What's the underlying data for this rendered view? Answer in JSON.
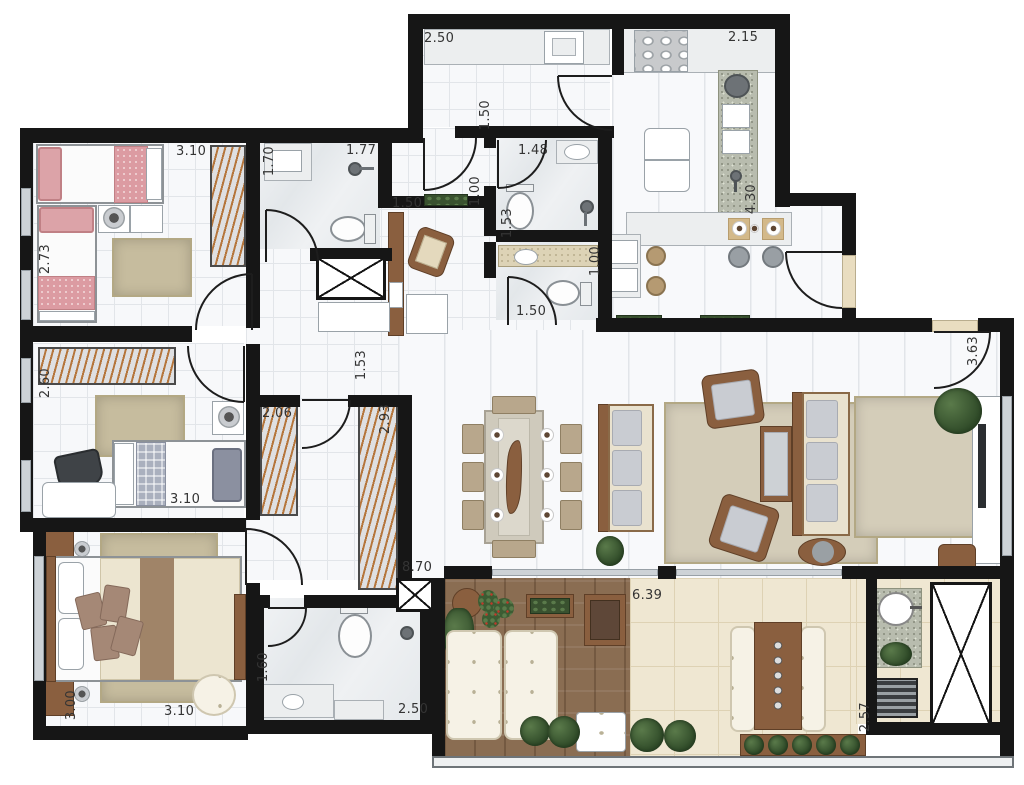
{
  "colors": {
    "wall": "#161616",
    "rug": "#c6bc9e",
    "cream": "#e9e2cf",
    "sill": "#e9ddc0",
    "label": "#343434",
    "pink": "#dca3a8",
    "deck": "#8a6d52",
    "btile": "#efe7d2",
    "granite": "#b8bcae",
    "wood": "#8a5f3f"
  },
  "dimensions": {
    "service_width": "2.50",
    "kitchen_width": "2.15",
    "service_depth": "1.50",
    "bath_social_width": "1.48",
    "office_niche": "1.00",
    "bath1_depth": "1.70",
    "bath1_width": "1.77",
    "bath1_lower": "1.50",
    "bedroom1_width": "3.10",
    "bedroom1_depth": "2.73",
    "bath_social_depth": "1.53",
    "lavabo_depth": "1.00",
    "lavabo_width": "1.50",
    "kitchen_depth": "4.30",
    "hall_width": "1.53",
    "bedroom2_depth": "2.60",
    "bedroom2_width": "3.10",
    "closet_left": "2.06",
    "closet_right": "2.93",
    "tv_room_depth": "3.63",
    "living_length": "8.70",
    "master_depth": "3.00",
    "master_width": "3.10",
    "master_bath_width": "1.60",
    "master_bath_length": "2.50",
    "balcony_length": "6.39",
    "balcony_depth": "2.57"
  }
}
